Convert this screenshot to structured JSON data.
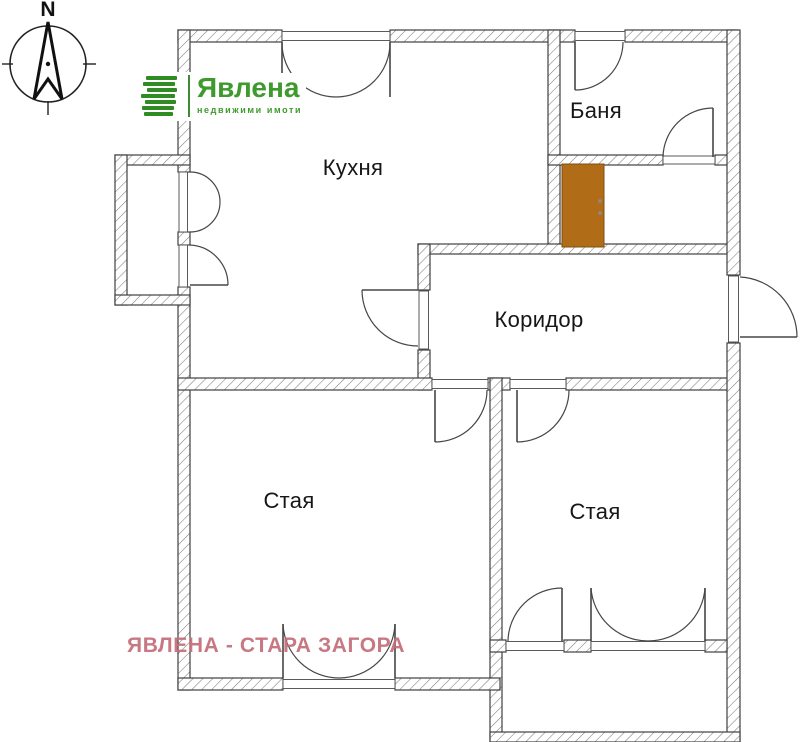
{
  "page": {
    "background": "#ffffff"
  },
  "compass": {
    "north_label": "N"
  },
  "logo": {
    "brand": "Явлена",
    "tagline": "недвижими имоти",
    "brand_color": "#3f9a2e"
  },
  "rooms": {
    "kitchen": {
      "label": "Кухня"
    },
    "bathroom": {
      "label": "Баня"
    },
    "corridor": {
      "label": "Коридор"
    },
    "room_left": {
      "label": "Стая"
    },
    "room_right": {
      "label": "Стая"
    }
  },
  "entrance_door": {
    "color": "#b06c16"
  },
  "watermark": {
    "text": "ЯВЛЕНА - СТАРА ЗАГОРА",
    "color": "#c36d79"
  }
}
